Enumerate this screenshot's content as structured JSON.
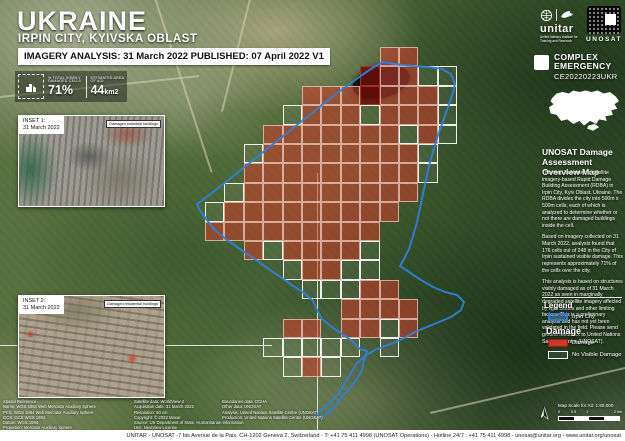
{
  "header": {
    "country": "UKRAINE",
    "subtitle": "IRPIN CITY, KYIVSKA OBLAST",
    "analysis_line": "IMAGERY ANALYSIS: 31 March 2022 PUBLISHED: 07 April 2022 V1"
  },
  "stats": {
    "damaged_label": "% TOTAL VISIBLY DAMAGED CELLS",
    "damaged_value": "71%",
    "area_label": "ESTIMATED AREA OF AOI",
    "area_value": "44",
    "area_unit": "km2"
  },
  "branding": {
    "unitar_word": "unitar",
    "unitar_tagline": "United Nations Institute for Training and Research",
    "unosat_word": "UNOSAT",
    "emergency_type_line1": "COMPLEX",
    "emergency_type_line2": "EMERGENCY",
    "emergency_code": "CE20220223UKR"
  },
  "sidebar": {
    "title": "UNOSAT Damage Assessment Overview Map",
    "paragraphs": [
      "This map illustrates a satellite imagery-based Rapid Damage Building Assessment (RDBA) in Irpin City, Kyiv Oblast, Ukraine. The RDBA divides the city into 500m x 500m cells, each of which is analyzed to determine whether or not there are damaged buildings inside the cell.",
      "Based on imagery collected on 31 March 2022, analysts found that 176 cells out of 248 in the City of Irpin sustained visible damage. This represents approximately 71% of the cells over the city.",
      "This analysis is based on structures visibly damaged as of 31 March 2022 as seen in marginally degraded satellite imagery affected by light clouds and other limiting factors. This is a preliminary analysis and has not yet been validated in the field. Please send ground feedback to United Nations Satellite Centre (UNOSAT)."
    ],
    "legend": {
      "title": "Legend",
      "irpin_label": "Irpin City",
      "damage_heading": "Damage",
      "damage_label": "Damage",
      "no_visible_label": "No Visible Damage"
    },
    "scale_text": "Map Scale for A3: 1:60,000",
    "scale_ticks": [
      "0",
      "0.5",
      "1",
      "2 km"
    ]
  },
  "insets": [
    {
      "label": "INSET 1:",
      "date": "31 March 2022",
      "callout": "Damaged industrial buildings"
    },
    {
      "label": "INSET 2:",
      "date": "31 March 2022",
      "callout": "Damaged residential buildings"
    }
  ],
  "credits": {
    "spatial": [
      "Spatial Reference",
      "Name: WGS 1984 Web Mercator Auxiliary Sphere",
      "PCS: WGS 1984 Web Mercator Auxiliary Sphere",
      "GCS: GCS WGS 1984",
      "Datum: WGS 1984",
      "Projection: Mercator Auxiliary Sphere"
    ],
    "satellite": [
      "Satellite data: WorldView-2",
      "Acquisition date: 31 March 2022",
      "Resolution: 50 cm",
      "Copyright: © 2022 Maxar",
      "Source: US Department of State, Humanitarian Information",
      "Unit, NextView License"
    ],
    "production": [
      "Boundaries data: OCHA",
      "Other data: UNOSAT",
      "Analysis: United Nations Satellite Centre (UNOSAT)",
      "Production: United Nations Satellite Centre (UNOSAT)"
    ]
  },
  "footer": "UNITAR - UNOSAT -7 bis Avenue de la Paix, CH-1202 Geneva 2, Switzerland - T: +41 75 411 4998 (UNOSAT Operations) - Hotline 24/7 : +41 75 411 4998 - unosat@unitar.org - www.unitar.org/unosat",
  "map_grid": {
    "type": "heatmap",
    "description": "500m x 500m damage assessment cells over Irpin City",
    "damaged_cells": 176,
    "total_cells": 248,
    "percent_damaged": "71%",
    "origin_x": 205,
    "origin_y": 47,
    "cell_size": 19.4,
    "rows": [
      ".........RR....",
      "........DRRWW..",
      ".....RRRDRRRW..",
      "....WRRRWRRRW..",
      "...RRRRRRRWRW..",
      "..WRRRRRRRRW...",
      "..RRRRRRRRRW...",
      ".WRRRRRRRRR....",
      "WRRRRRRRRR.....",
      "RRRRRRRRR......",
      "..RWRRRRW......",
      "....WRRWW......",
      ".....WWWRR.....",
      ".......RRRR....",
      "....RR.RRWR....",
      "...WWWWW.W.....",
      "....WRW........",
      "..............."
    ],
    "colors": {
      "damage_fill": "rgba(208,58,43,0.55)",
      "damage_border": "rgba(255,222,212,0.65)",
      "damage_dark_fill": "rgba(108,12,8,0.82)",
      "damage_dark_border": "rgba(200,60,40,0.7)",
      "no_visible_fill": "rgba(255,255,255,0.06)",
      "no_visible_border": "rgba(255,255,255,0.9)",
      "boundary": "#2f7fd6",
      "damage_hex": "#cf372a"
    }
  }
}
